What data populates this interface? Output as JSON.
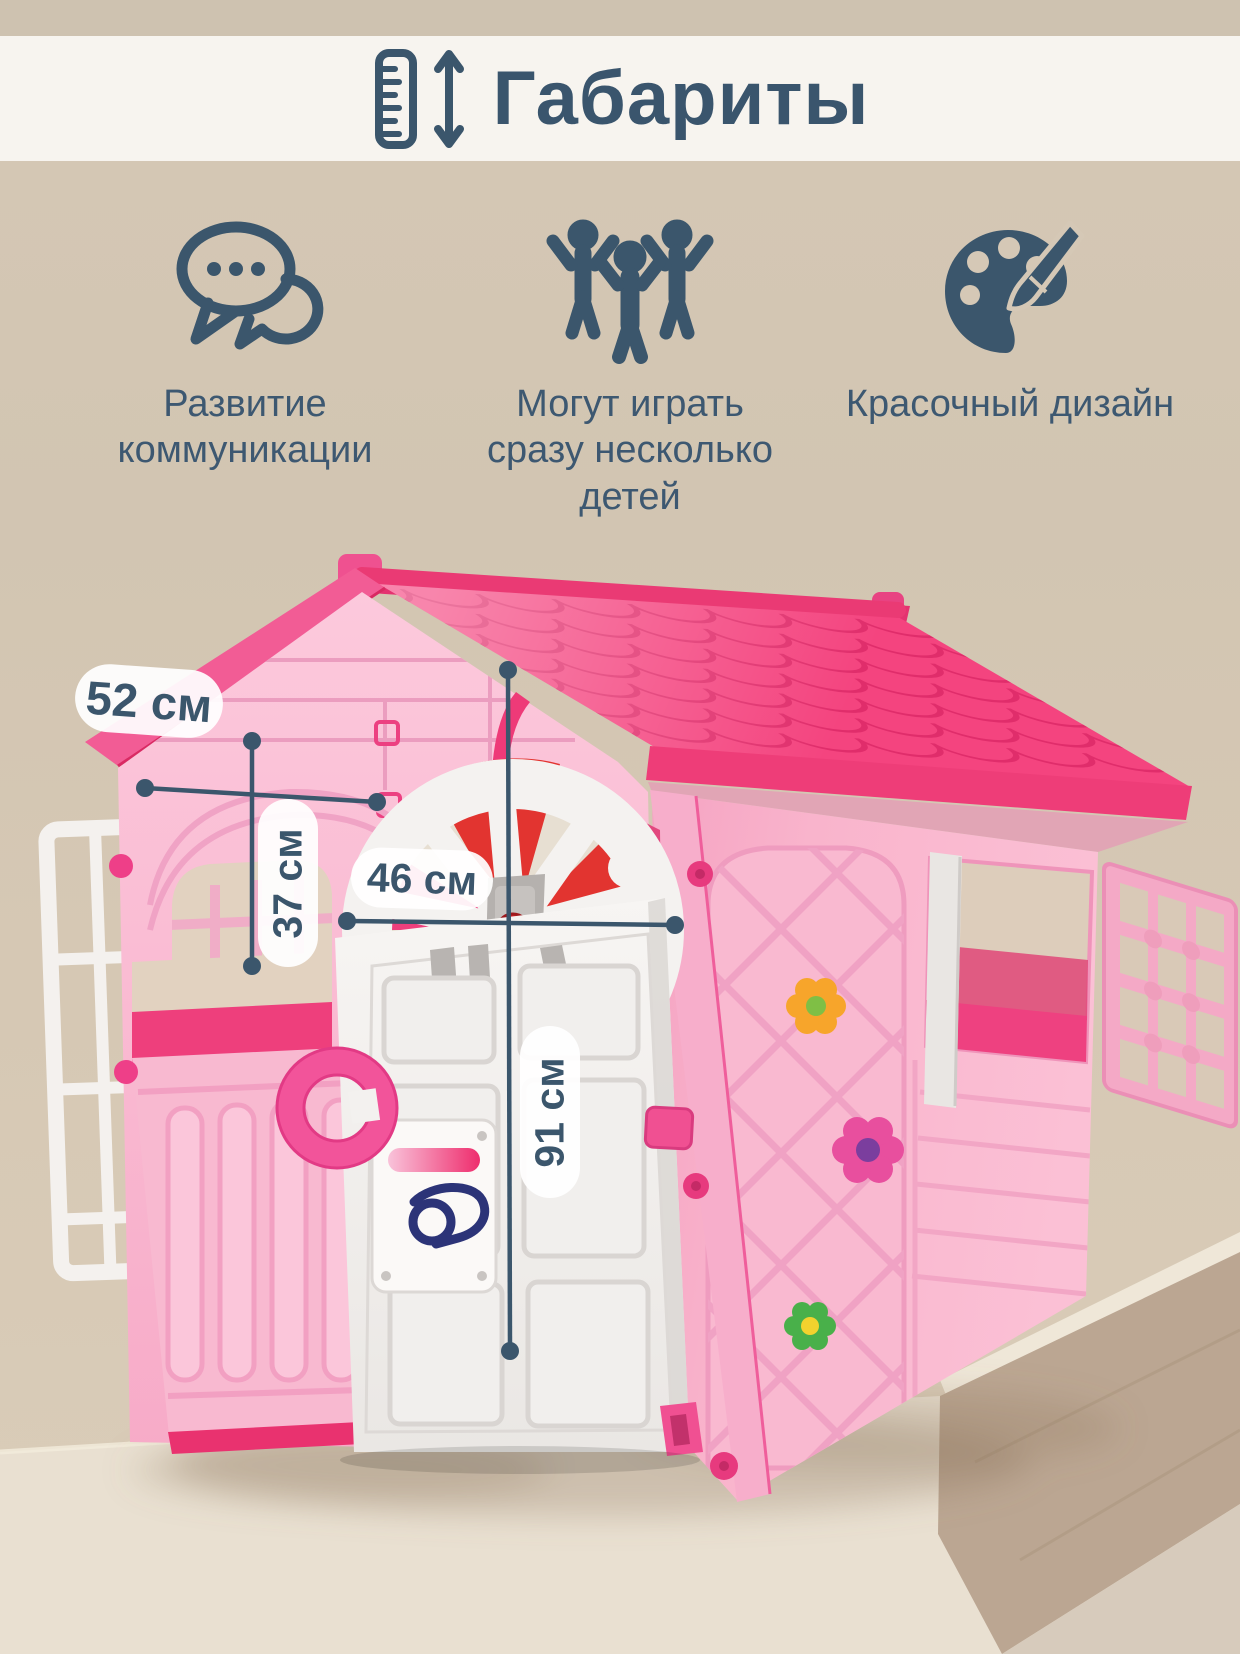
{
  "header": {
    "title": "Габариты",
    "icons": [
      "ruler-icon",
      "height-arrow-icon"
    ]
  },
  "features": [
    {
      "icon": "speech-bubbles-icon",
      "text": "Развитие коммуникации"
    },
    {
      "icon": "children-icon",
      "text": "Могут играть сразу несколько детей"
    },
    {
      "icon": "palette-icon",
      "text": "Красочный дизайн"
    }
  ],
  "dimensions": [
    {
      "id": "side-width",
      "label": "52 см",
      "orientation": "horizontal"
    },
    {
      "id": "window-height",
      "label": "37 см",
      "orientation": "vertical"
    },
    {
      "id": "door-width",
      "label": "46 см",
      "orientation": "horizontal"
    },
    {
      "id": "door-height",
      "label": "91 см",
      "orientation": "vertical"
    }
  ],
  "colors": {
    "accent_text": "#3b566c",
    "roof": "#f4447f",
    "roof_shadow": "#e02d6b",
    "walls": "#f9bcd3",
    "hot_pink": "#ee3f7c",
    "door": "#f3f1ef",
    "red_wheel": "#e23430",
    "navy_logo": "#2c3478",
    "background_top": "#f7f4ef",
    "background_mid": "#d2c5b2",
    "label_bg": "#ffffff"
  }
}
